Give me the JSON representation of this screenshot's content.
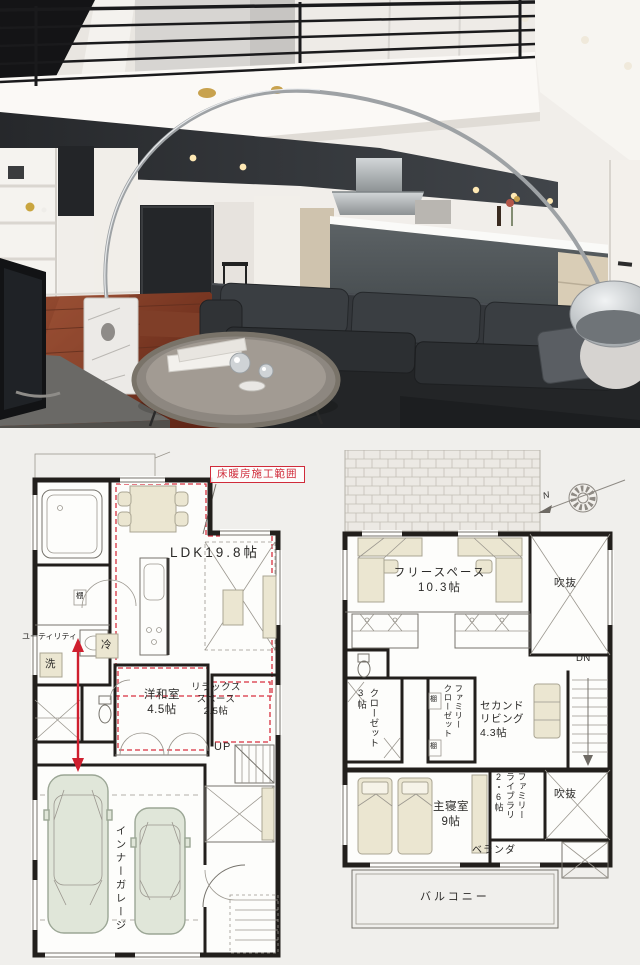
{
  "photo": {
    "subject": "LDK interior with loft",
    "colors": {
      "ceiling_accent": "#34383c",
      "floor_wood": "#7c3b26",
      "sofa_leather": "#2b2d2f",
      "kitchen_island": "#4d5355",
      "cabinet_wood": "#d9cdb6"
    }
  },
  "plan_1f": {
    "floor_heating_label": "床暖房施工範囲",
    "ldk": "LDK19.8帖",
    "utility": "ユーティリティ",
    "washer": "洗",
    "fridge": "冷",
    "shelf": "棚",
    "japanese_room": "洋和室\n4.5帖",
    "relax_space": "リラックス\nスペース\n2.5帖",
    "up": "UP",
    "inner_garage": "インナーガレージ"
  },
  "plan_2f": {
    "free_space": "フリースペース\n10.3帖",
    "void_top": "吹抜",
    "void_bottom": "吹抜",
    "dn": "DN",
    "closet_3jo": "クローゼット\n3帖",
    "family_closet": "ファミリー\nクローゼット",
    "shelf_top": "棚",
    "shelf_bottom": "棚",
    "second_living": "セカンド\nリビング\n4.3帖",
    "master_bedroom": "主寝室\n9帖",
    "family_library": "ファミリー\nライブラリ\n2・6帖",
    "veranda": "ベランダ",
    "balcony": "バルコニー",
    "north": "N"
  }
}
